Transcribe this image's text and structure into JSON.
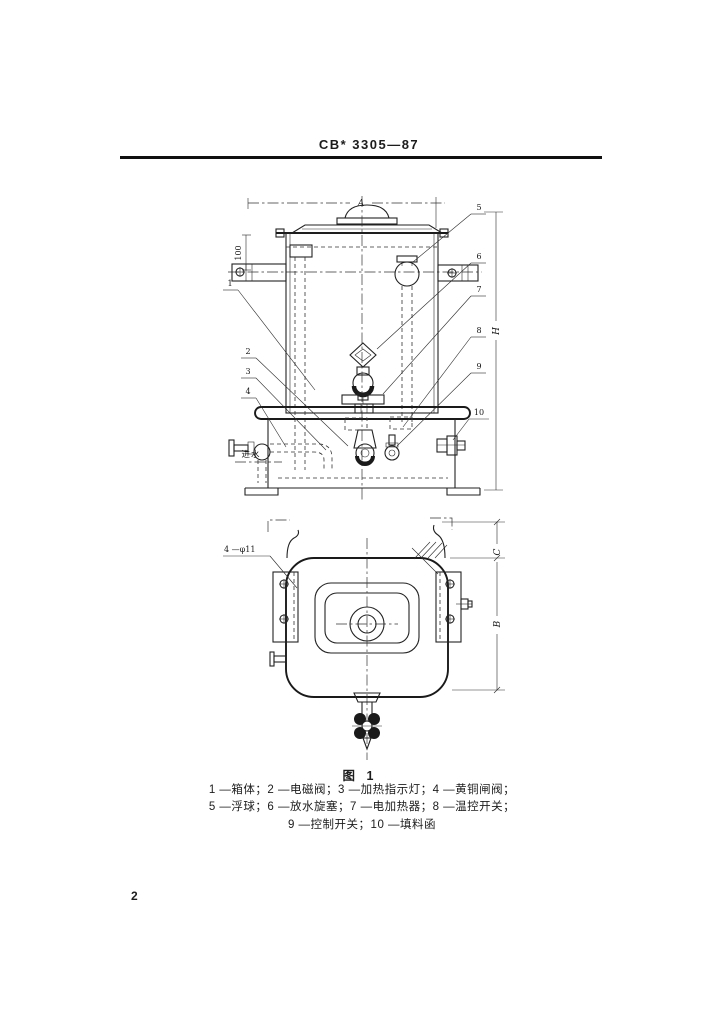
{
  "document": {
    "standard_number": "CB* 3305—87",
    "page_number": "2"
  },
  "figure": {
    "caption": "图 1",
    "legend_lines": [
      "1 —箱体；2 —电磁阀；3 —加热指示灯；4 —黄铜闸阀；",
      "5 —浮球；6 —放水旋塞；7 —电加热器；8 —温控开关；",
      "9 —控制开关；10 —填料函"
    ],
    "callouts_left": [
      "1",
      "2",
      "3",
      "4"
    ],
    "callouts_right": [
      "5",
      "6",
      "7",
      "8",
      "9",
      "10"
    ],
    "labels": {
      "dim_width": "A",
      "dim_height": "H",
      "dim_top": "100",
      "dim_plan_c": "C",
      "dim_plan_b": "B",
      "holes": "4 —φ11",
      "inlet": "进水"
    }
  },
  "ink_color": "#1c1c1c"
}
